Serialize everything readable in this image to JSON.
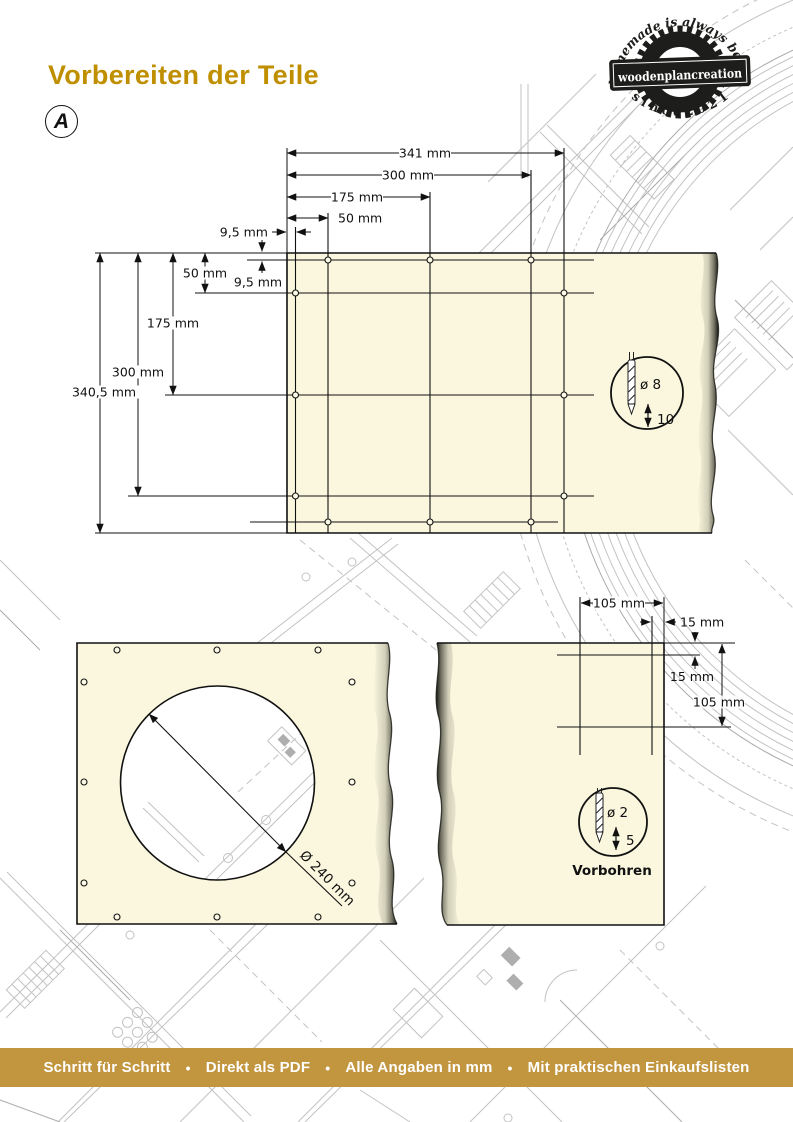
{
  "page_title": "Vorbereiten der Teile",
  "step_badge": "A",
  "logo": {
    "arc_top": "homemade is always better",
    "name": "woodenplancreation",
    "arc_bottom": "s i n c e   2 0 2 1"
  },
  "colors": {
    "accent_gold": "#BF8F00",
    "footer_bar": "#C2953F",
    "panel_fill": "#FAF7DE",
    "line": "#111111",
    "logo_ink": "#1D1D1B"
  },
  "drawing_top": {
    "dims_top": {
      "width_total": "341 mm",
      "width_300": "300 mm",
      "width_175": "175 mm",
      "width_50": "50 mm",
      "edge_offset": "9,5 mm"
    },
    "dims_left": {
      "height_50": "50 mm",
      "edge_offset": "9,5 mm",
      "height_175": "175 mm",
      "height_300": "300 mm",
      "height_total": "340,5 mm"
    },
    "drill_detail": {
      "diameter": "ø 8",
      "depth": "10"
    }
  },
  "drawing_bottom_left": {
    "hole_diameter": "Ø 240 mm"
  },
  "drawing_bottom_right": {
    "dims": {
      "top_105": "105 mm",
      "top_15": "15 mm",
      "side_15": "15 mm",
      "side_105": "105 mm"
    },
    "drill_detail": {
      "diameter": "ø 2",
      "depth": "5",
      "caption": "Vorbohren"
    }
  },
  "footer": {
    "separator": "•",
    "items": [
      "Schritt für Schritt",
      "Direkt als PDF",
      "Alle Angaben in mm",
      "Mit praktischen Einkaufslisten"
    ]
  }
}
